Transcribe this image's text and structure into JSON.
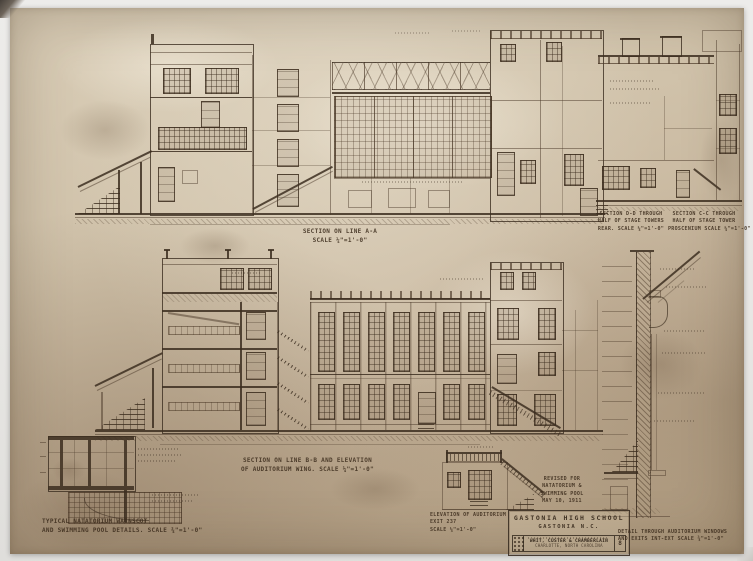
{
  "colors": {
    "paper": "#cbbca4",
    "ink": "#4a3827",
    "photo_border": "#ebebe9"
  },
  "captions": {
    "aa": [
      "SECTION ON LINE A-A",
      "SCALE ¼\"=1'-0\""
    ],
    "dd": [
      "SECTION D-D THROUGH",
      "HALF OF STAGE TOWERS",
      "REAR. SCALE ¼\"=1'-0\""
    ],
    "cc": [
      "SECTION C-C THROUGH",
      "HALF OF STAGE TOWER",
      "PROSCENIUM SCALE ¼\"=1'-0\""
    ],
    "bb": [
      "SECTION ON LINE B-B AND ELEVATION",
      "OF AUDITORIUM WING. SCALE ¼\"=1'-0\""
    ],
    "nat": [
      "TYPICAL NATATORIUM WAINSCOT",
      "AND SWIMMING POOL DETAILS. SCALE ¾\"=1'-0\""
    ],
    "exit": [
      "ELEVATION OF AUDITORIUM",
      "EXIT 237",
      "SCALE ¼\"=1'-0\""
    ],
    "windet": [
      "DETAIL THROUGH AUDITORIUM WINDOWS",
      "AND EXITS INT-EXT SCALE ¾\"=1'-0\""
    ]
  },
  "title_block": {
    "revision": [
      "REVISED FOR",
      "NATATORIUM &",
      "SWIMMING POOL",
      "MAY 10, 1911"
    ],
    "project": "GASTONIA HIGH SCHOOL",
    "location": "GASTONIA N.C.",
    "architects": "WHIT, CUSTER & CHAMBERLAIN",
    "architects_location": "CHARLOTTE, NORTH CAROLINA",
    "sheet_number": "8"
  }
}
